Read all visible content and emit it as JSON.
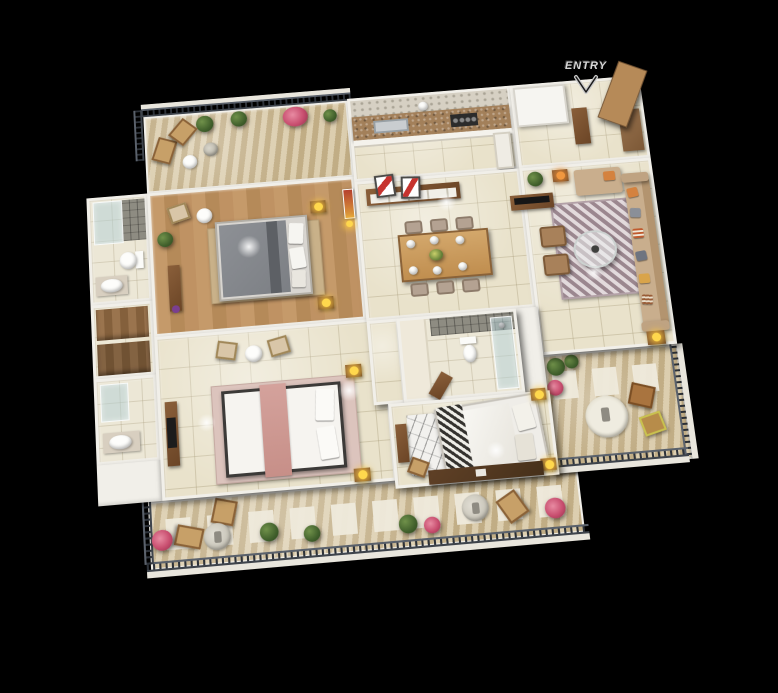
{
  "scene": {
    "title": "3D apartment floor plan render",
    "background_color": "#000000",
    "entry_marker": {
      "label": "ENTRY",
      "text_color": "#d6d6d6",
      "arrow_direction": "down"
    }
  },
  "palette": {
    "wall_white": "#f1efe9",
    "floor_tile_cream": "#e9e2cb",
    "floor_wood": "#bd9165",
    "balcony_stone": "#d2c099",
    "balcony_paver_white": "#efeadc",
    "railing_dark": "#2d3239",
    "railing_ledge": "#e9e6dd",
    "sofa_beige": "#c9ae8d",
    "cushion_orange": "#d4823f",
    "cushion_gray": "#8a8f98",
    "wood_dark": "#6b4526",
    "wood_mid": "#a87f52",
    "dining_table_wood": "#cfa268",
    "bed_gray": "#85888d",
    "bed_white": "#f6f4f0",
    "bed_runner_pink": "#cf9a94",
    "bed2_pattern_black": "#34322e",
    "rug_living_mauve": "#c6b5ba",
    "rug_tan": "#c9b189",
    "rug_pink": "#dcc4bd",
    "lamp_yellow": "#ffd84d",
    "lamp_orange": "#f0973f",
    "plant_green": "#41602c",
    "flower_pink": "#c84e6f",
    "glass_blue": "rgba(178,208,213,0.5)",
    "granite_counter": "#a3805a",
    "shower_tile_gray": "#8e8c82",
    "art_red": "#c6332e",
    "shrine_red_gold": "#b5402e"
  },
  "rooms": [
    {
      "name": "balcony-top-left",
      "floor": "stone-tile",
      "items": [
        "railing",
        "potted-plants",
        "pink-flower-bush",
        "lounge-chairs",
        "round-table",
        "statue-planter"
      ]
    },
    {
      "name": "bedroom-1",
      "floor": "wood",
      "items": [
        "gray-double-bed",
        "pillows",
        "area-rug",
        "armchair",
        "round-side-table",
        "nightstands",
        "table-lamps",
        "tall-plant",
        "console-cabinet",
        "shrine-art"
      ]
    },
    {
      "name": "bathroom-1",
      "floor": "tile",
      "items": [
        "glass-shower",
        "gray-tile-wall",
        "toilet",
        "wash-basin",
        "vanity-counter"
      ]
    },
    {
      "name": "walk-in-wardrobe",
      "floor": "tile",
      "items": [
        "wooden-wardrobes"
      ]
    },
    {
      "name": "bathroom-2",
      "floor": "tile",
      "items": [
        "glass-shower",
        "wash-basin",
        "vanity-counter"
      ]
    },
    {
      "name": "master-bedroom",
      "floor": "tile",
      "items": [
        "white-double-bed",
        "pink-runner",
        "pillows",
        "area-rug",
        "armchairs",
        "round-table",
        "nightstands",
        "table-lamps",
        "dresser-tv-unit"
      ]
    },
    {
      "name": "kitchen",
      "floor": "tile",
      "items": [
        "hex-tile-backsplash",
        "granite-counter",
        "sink",
        "hob",
        "lower-cabinets",
        "tall-unit",
        "crockery"
      ]
    },
    {
      "name": "dining",
      "floor": "tile",
      "items": [
        "six-seat-dining-table",
        "dining-chairs",
        "plates",
        "flower-centerpiece",
        "sideboard",
        "red-artworks"
      ]
    },
    {
      "name": "entry-foyer",
      "floor": "tile",
      "items": [
        "open-entry-door",
        "service-shaft",
        "tall-cabinet",
        "wardrobe-unit"
      ]
    },
    {
      "name": "living-room",
      "floor": "tile",
      "items": [
        "l-shaped-sofa",
        "colorful-cushions",
        "patterned-rug",
        "round-glass-coffee-table",
        "ottomans",
        "side-tables",
        "table-lamps",
        "tv-console",
        "television",
        "corner-plant"
      ]
    },
    {
      "name": "bathroom-3",
      "floor": "tile",
      "items": [
        "gray-tile-shower-wall",
        "toilet",
        "glass-partition",
        "wood-door"
      ]
    },
    {
      "name": "bedroom-2",
      "floor": "tile",
      "items": [
        "patterned-double-bed",
        "pillows",
        "marble-pattern-rug",
        "study-desk",
        "desk-chair",
        "dresser",
        "nightstands",
        "table-lamps"
      ]
    },
    {
      "name": "balcony-right",
      "floor": "stone-tile",
      "items": [
        "railing",
        "wicker-chair",
        "folding-chair",
        "round-rug",
        "statue",
        "potted-plants",
        "pink-flowers"
      ]
    },
    {
      "name": "balcony-bottom",
      "floor": "stone-tile",
      "items": [
        "railing",
        "white-pavers",
        "lounge-chairs",
        "statue-planters",
        "potted-plants",
        "pink-flower-bushes",
        "round-table"
      ]
    }
  ]
}
